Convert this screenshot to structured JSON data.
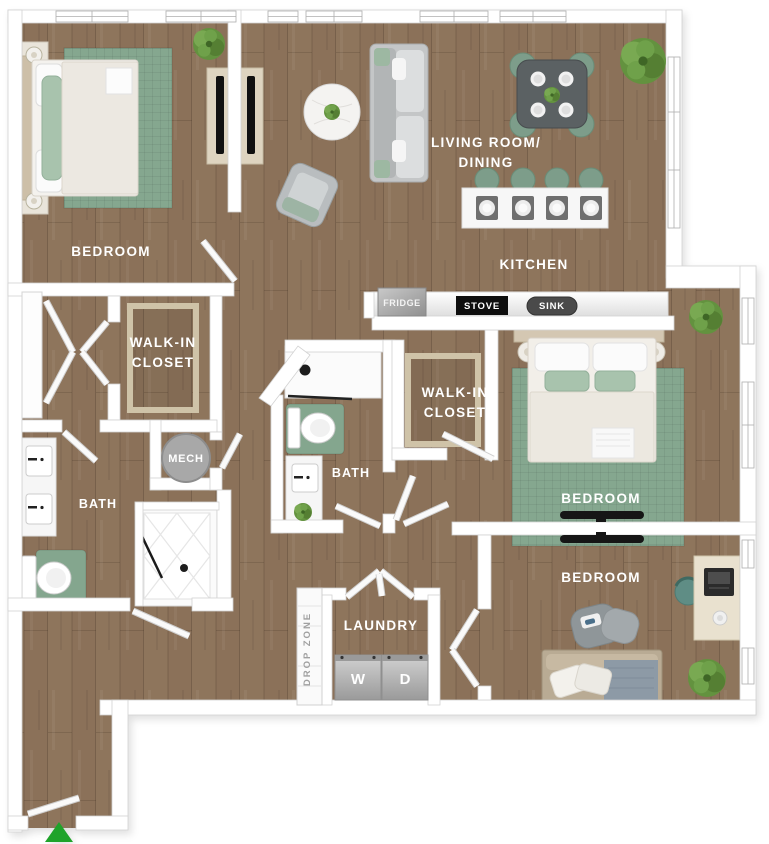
{
  "floor_plan": {
    "rooms": {
      "bedroom_top_left": {
        "label": "BEDROOM"
      },
      "living_dining": {
        "label_line1": "LIVING ROOM/",
        "label_line2": "DINING"
      },
      "kitchen": {
        "label": "KITCHEN"
      },
      "walk_in_closet_left": {
        "label_line1": "WALK-IN",
        "label_line2": "CLOSET"
      },
      "walk_in_closet_middle": {
        "label_line1": "WALK-IN",
        "label_line2": "CLOSET"
      },
      "mech": {
        "label": "MECH"
      },
      "bath_left": {
        "label": "BATH"
      },
      "bath_middle": {
        "label": "BATH"
      },
      "bedroom_right": {
        "label": "BEDROOM"
      },
      "bedroom_bottom_right": {
        "label": "BEDROOM"
      },
      "laundry": {
        "label": "LAUNDRY"
      },
      "drop_zone": {
        "label": "DROP ZONE"
      }
    },
    "appliances": {
      "fridge": "FRIDGE",
      "stove": "STOVE",
      "sink": "SINK",
      "washer": "W",
      "dryer": "D"
    },
    "colors": {
      "wood_floor": "#8b7159",
      "rug_green": "#85a78f",
      "plant_green": "#63923f",
      "entry_arrow_green": "#1fa32a",
      "wall_white": "#ffffff",
      "stove_black": "#0e0e0e",
      "sink_gray": "#4a4a4a",
      "fridge_gray": "#a5a5a5",
      "appliance_gray": "#b5b5b5",
      "label_white": "#ffffff"
    }
  }
}
